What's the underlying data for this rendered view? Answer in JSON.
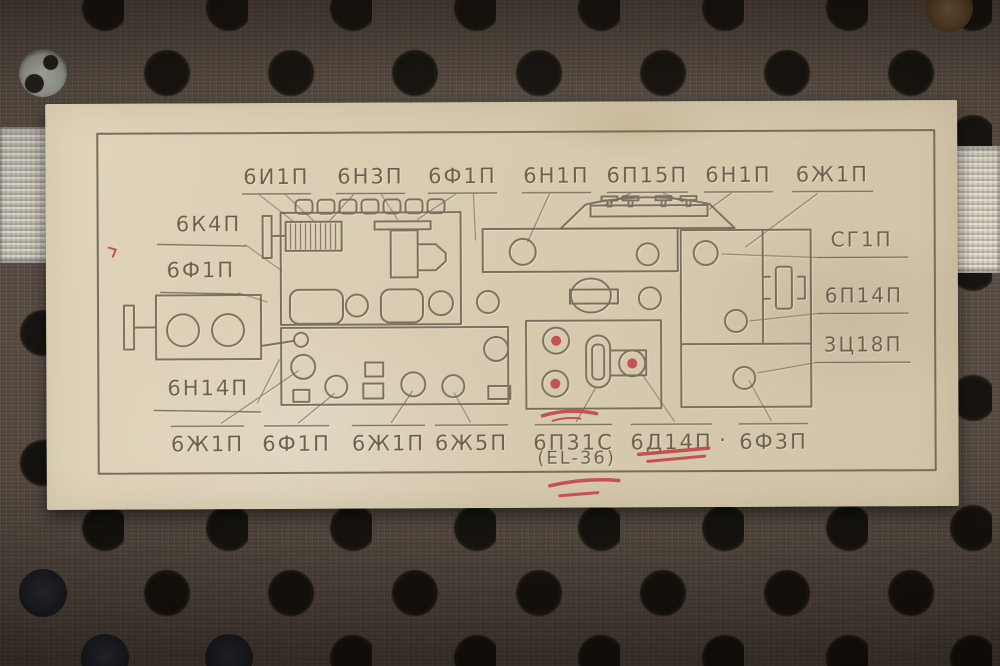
{
  "label": {
    "top_row": [
      "6И1П",
      "6Н3П",
      "6Ф1П",
      "6Н1П",
      "6П15П",
      "6Н1П",
      "6Ж1П"
    ],
    "left_column": [
      "6К4П",
      "6Ф1П",
      "6Н14П"
    ],
    "right_column": [
      "СГ1П",
      "6П14П",
      "3Ц18П"
    ],
    "bottom_row": [
      "6Ж1П",
      "6Ф1П",
      "6Ж1П",
      "6Ж5П",
      "6П31С",
      "6Д14П",
      "6Ф3П"
    ],
    "bottom_separator": "·",
    "equivalent_note": "(EL-36)"
  },
  "annotations": {
    "red_overlined_label": "6П31С",
    "red_underlined_label": "6Д14П",
    "red_marked_socket_count": 3
  },
  "colors": {
    "paper": "#d8ccb1",
    "ink": "#6e6352",
    "annotation_red": "#c4454b",
    "board": "#4f443b",
    "hole": "#0d0a06",
    "strap": "#c9c3b5"
  }
}
